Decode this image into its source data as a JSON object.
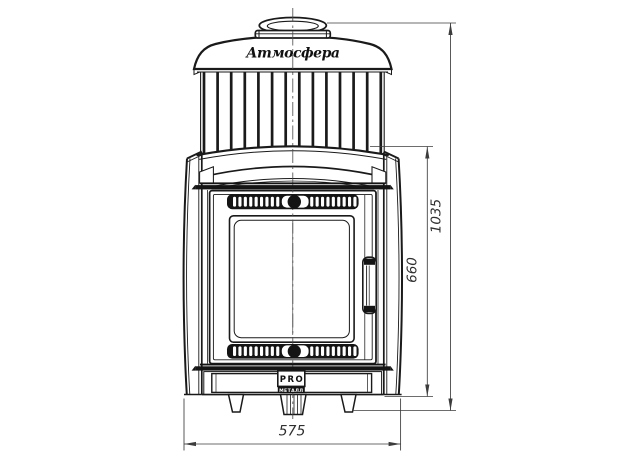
{
  "drawing": {
    "brand_script": "Атмосфера",
    "manufacturer_logo": {
      "top": "PRO",
      "bottom": "МЕТАЛЛ"
    },
    "dimensions": {
      "overall_height_mm": "1035",
      "body_height_mm": "660",
      "base_width_mm": "575"
    },
    "colors": {
      "line": "#1a1a1a",
      "dimension": "#3c3c3c",
      "background": "#ffffff"
    }
  }
}
